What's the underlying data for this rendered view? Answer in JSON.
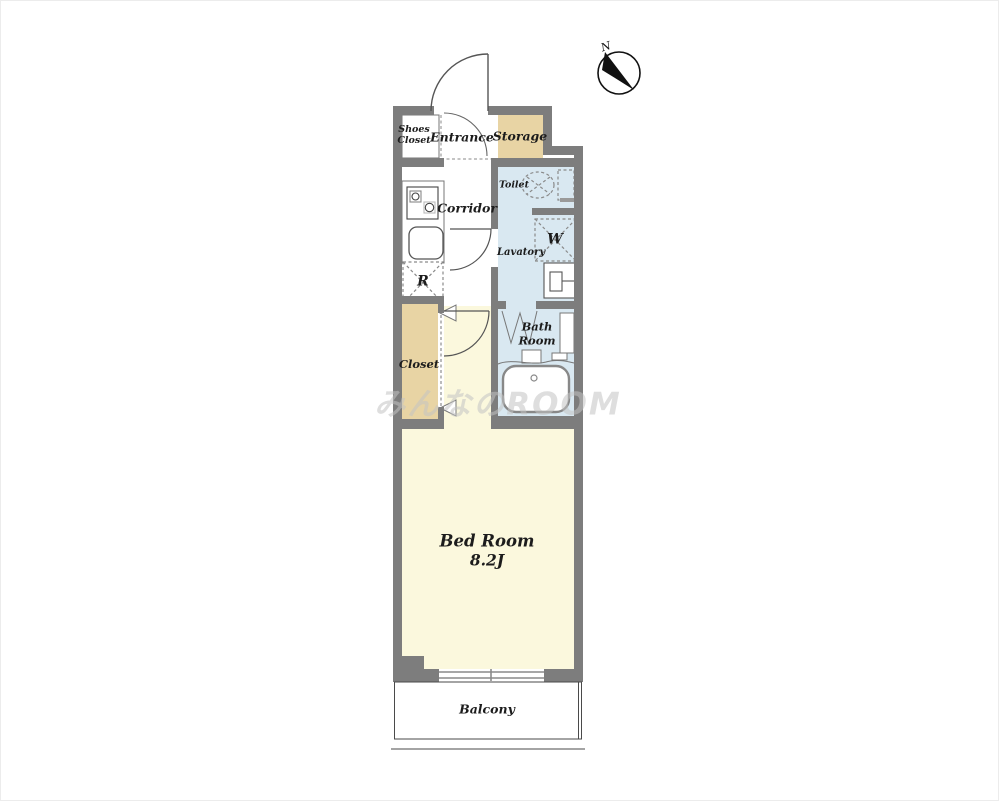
{
  "colors": {
    "wall": "#7d7d7d",
    "tan": "#e8d4a4",
    "water": "#d9e8f1",
    "bedroom": "#fbf8dd",
    "white": "#ffffff"
  },
  "compass": {
    "north_label": "N"
  },
  "rooms": {
    "shoes_closet": {
      "label": "Shoes\nCloset"
    },
    "entrance": {
      "label": "Entrance"
    },
    "storage": {
      "label": "Storage"
    },
    "corridor": {
      "label": "Corridor"
    },
    "toilet": {
      "label": "Toilet"
    },
    "lavatory": {
      "label": "Lavatory"
    },
    "closet": {
      "label": "Closet"
    },
    "bath_room": {
      "label": "Bath\nRoom"
    },
    "bed_room": {
      "label": "Bed Room",
      "size": "8.2J"
    },
    "balcony": {
      "label": "Balcony"
    }
  },
  "fixtures": {
    "refrigerator_label": "R",
    "washer_label": "W"
  },
  "watermark": {
    "text": "みんなのROOM"
  }
}
